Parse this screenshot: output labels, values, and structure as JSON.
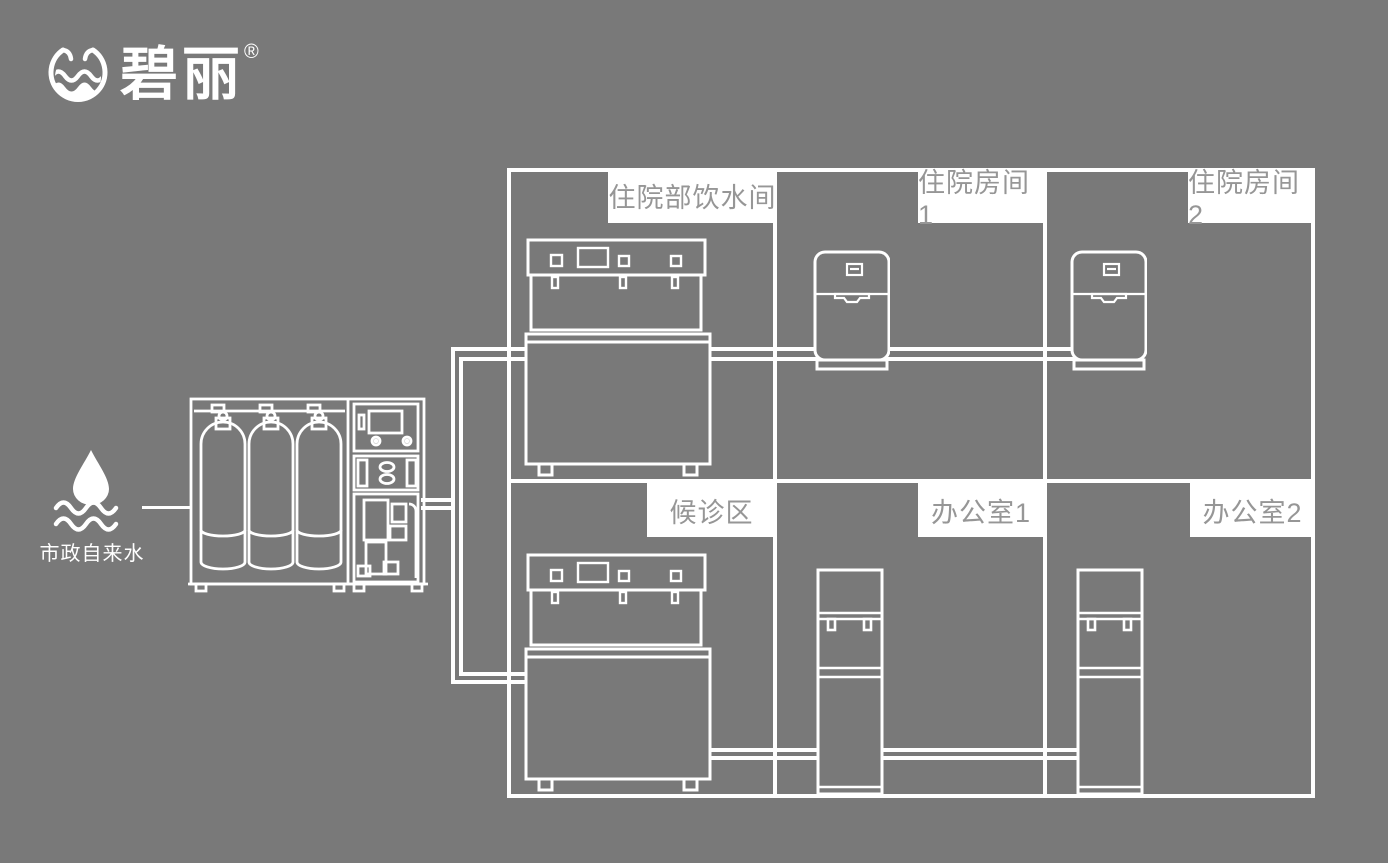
{
  "colors": {
    "background": "#797979",
    "line": "#ffffff",
    "label_box_bg": "#ffffff",
    "label_text": "#969696"
  },
  "logo": {
    "brand_text": "碧丽",
    "registered_mark": "®",
    "icon": "bili-water-cup-logo-icon"
  },
  "water_source": {
    "label": "市政自来水",
    "icon": "water-drop-with-waves-icon"
  },
  "equipment": {
    "purifier_unit": "central-water-purification-machine",
    "dispenser_types": [
      "large-counter-dispenser",
      "small-countertop-dispenser",
      "floor-standing-dispenser"
    ]
  },
  "rooms": [
    {
      "label": "住院部饮水间",
      "dispenser": "large-counter-dispenser"
    },
    {
      "label": "住院房间1",
      "dispenser": "small-countertop-dispenser"
    },
    {
      "label": "住院房间2",
      "dispenser": "small-countertop-dispenser"
    },
    {
      "label": "候诊区",
      "dispenser": "large-counter-dispenser"
    },
    {
      "label": "办公室1",
      "dispenser": "floor-standing-dispenser"
    },
    {
      "label": "办公室2",
      "dispenser": "floor-standing-dispenser"
    }
  ]
}
